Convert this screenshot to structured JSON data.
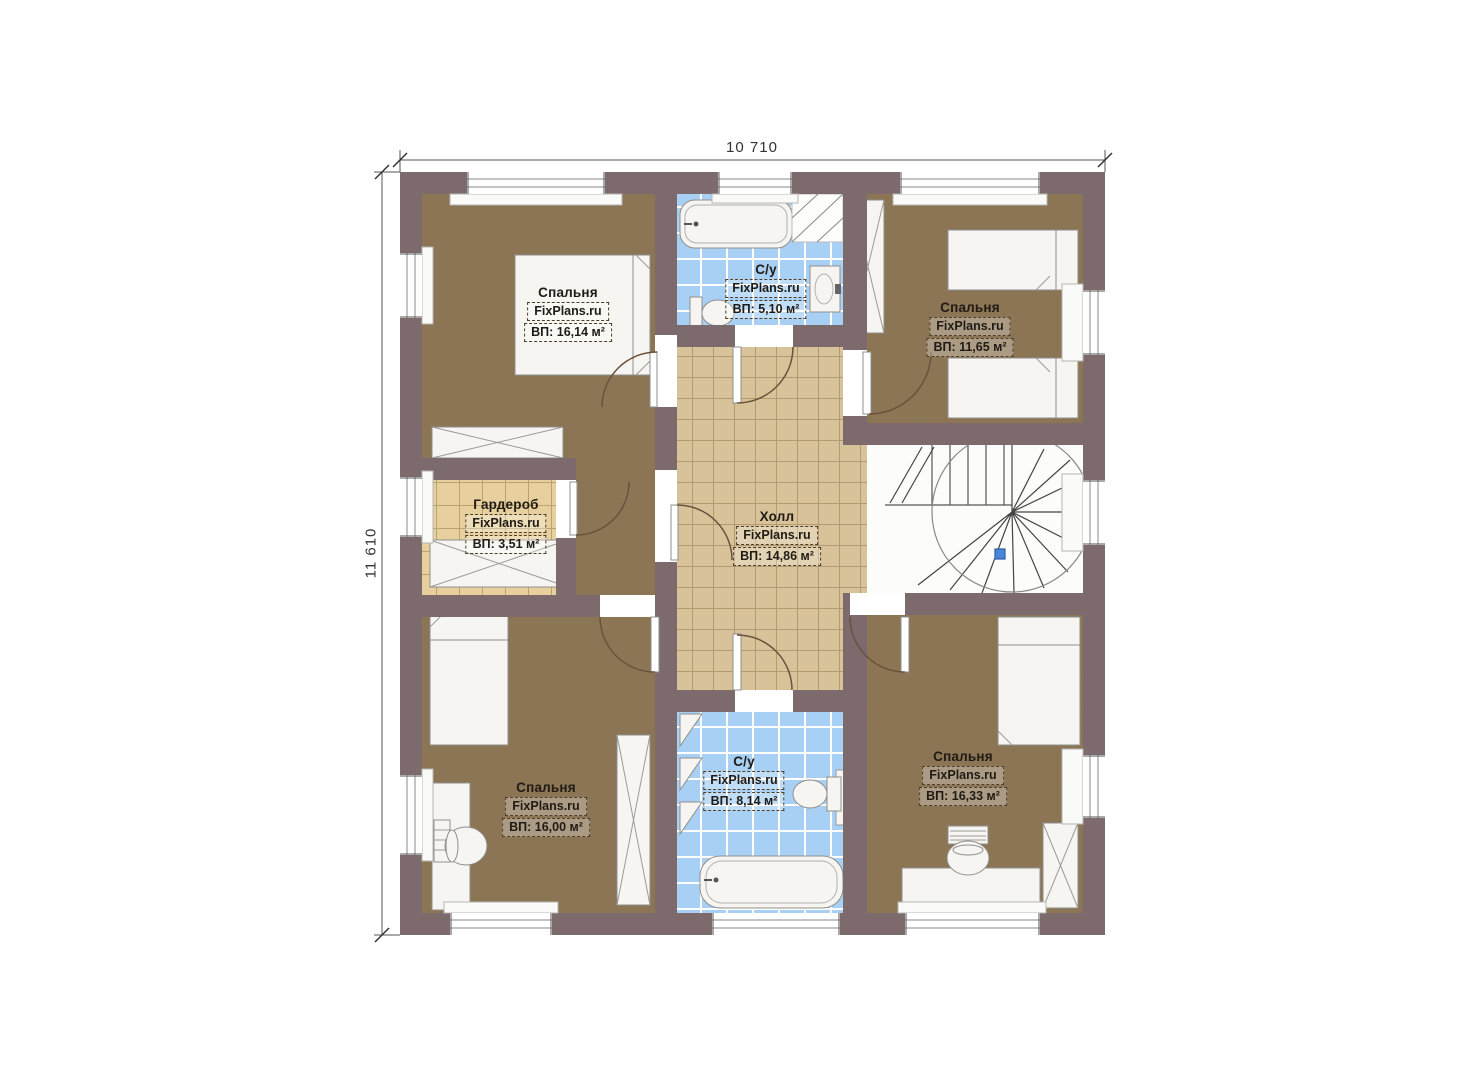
{
  "plan": {
    "dimension_top": "10 710",
    "dimension_left": "11 610",
    "watermark": "FixPlans.ru",
    "colors": {
      "wall": "#7d6a6c",
      "bedroom_floor": "#8c7454",
      "hall_floor": "#d8c299",
      "wardrobe_floor": "#e7d09e",
      "bathroom_floor": "#a8d0f4",
      "furniture": "#f6f5f2",
      "stair_marker": "#4a86d8"
    },
    "rooms": [
      {
        "id": "bedroom-top-left",
        "name": "Спальня",
        "watermark": "FixPlans.ru",
        "area_label": "ВП: 16,14 м²"
      },
      {
        "id": "bathroom-top",
        "name": "С/у",
        "watermark": "FixPlans.ru",
        "area_label": "ВП: 5,10 м²"
      },
      {
        "id": "bedroom-top-right",
        "name": "Спальня",
        "watermark": "FixPlans.ru",
        "area_label": "ВП: 11,65 м²"
      },
      {
        "id": "wardrobe",
        "name": "Гардероб",
        "watermark": "FixPlans.ru",
        "area_label": "ВП: 3,51 м²"
      },
      {
        "id": "hall",
        "name": "Холл",
        "watermark": "FixPlans.ru",
        "area_label": "ВП: 14,86 м²"
      },
      {
        "id": "bedroom-bottom-left",
        "name": "Спальня",
        "watermark": "FixPlans.ru",
        "area_label": "ВП: 16,00 м²"
      },
      {
        "id": "bathroom-bottom",
        "name": "С/у",
        "watermark": "FixPlans.ru",
        "area_label": "ВП: 8,14 м²"
      },
      {
        "id": "bedroom-bottom-right",
        "name": "Спальня",
        "watermark": "FixPlans.ru",
        "area_label": "ВП: 16,33 м²"
      }
    ]
  }
}
